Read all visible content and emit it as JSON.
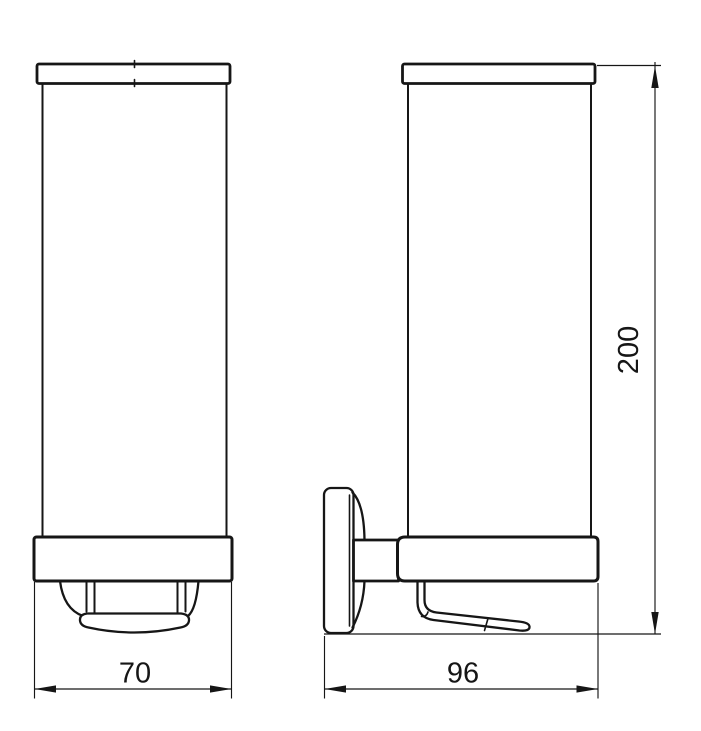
{
  "drawing": {
    "type": "technical-orthographic-drawing",
    "subject": "wall-mounted tumbler holder, front and side elevation",
    "dimension_labels": {
      "front_width": "70",
      "side_depth": "96",
      "overall_height": "200"
    },
    "colors": {
      "line": "#161616",
      "background": "#ffffff"
    }
  }
}
